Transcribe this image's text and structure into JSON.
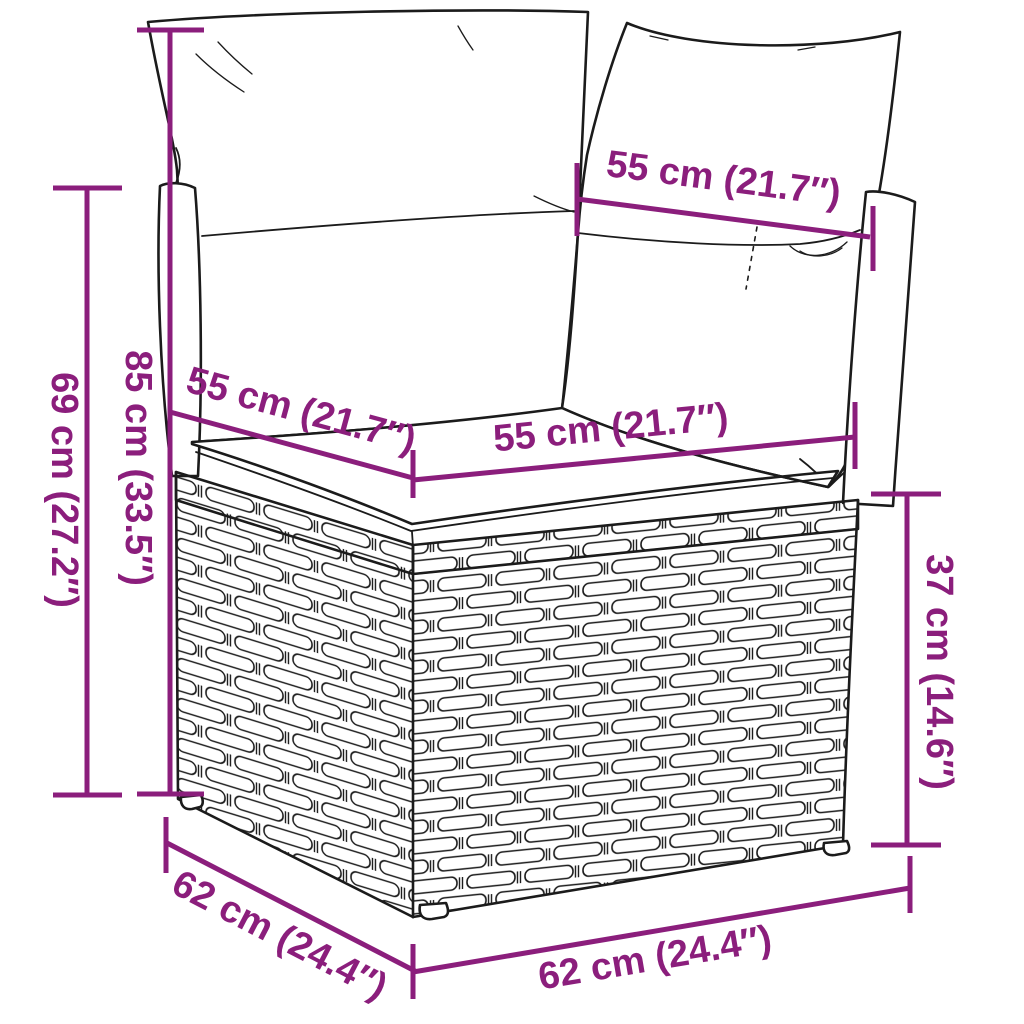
{
  "diagram": {
    "subject": "Rattan corner sofa section with cushions — product dimension diagram",
    "background_color": "#ffffff",
    "line_color": "#1b1b1b",
    "accent_color": "#8B1E7C",
    "dimensions": {
      "back_width": {
        "label": "55 cm (21.7″)"
      },
      "height_back": {
        "label": "69 cm (27.2″)"
      },
      "height_total": {
        "label": "85 cm (33.5″)"
      },
      "seat_depth": {
        "label": "55 cm (21.7″)"
      },
      "seat_width": {
        "label": "55 cm (21.7″)"
      },
      "seat_height": {
        "label": "37 cm (14.6″)"
      },
      "base_depth": {
        "label": "62 cm (24.4″)"
      },
      "base_width": {
        "label": "62 cm (24.4″)"
      }
    }
  }
}
